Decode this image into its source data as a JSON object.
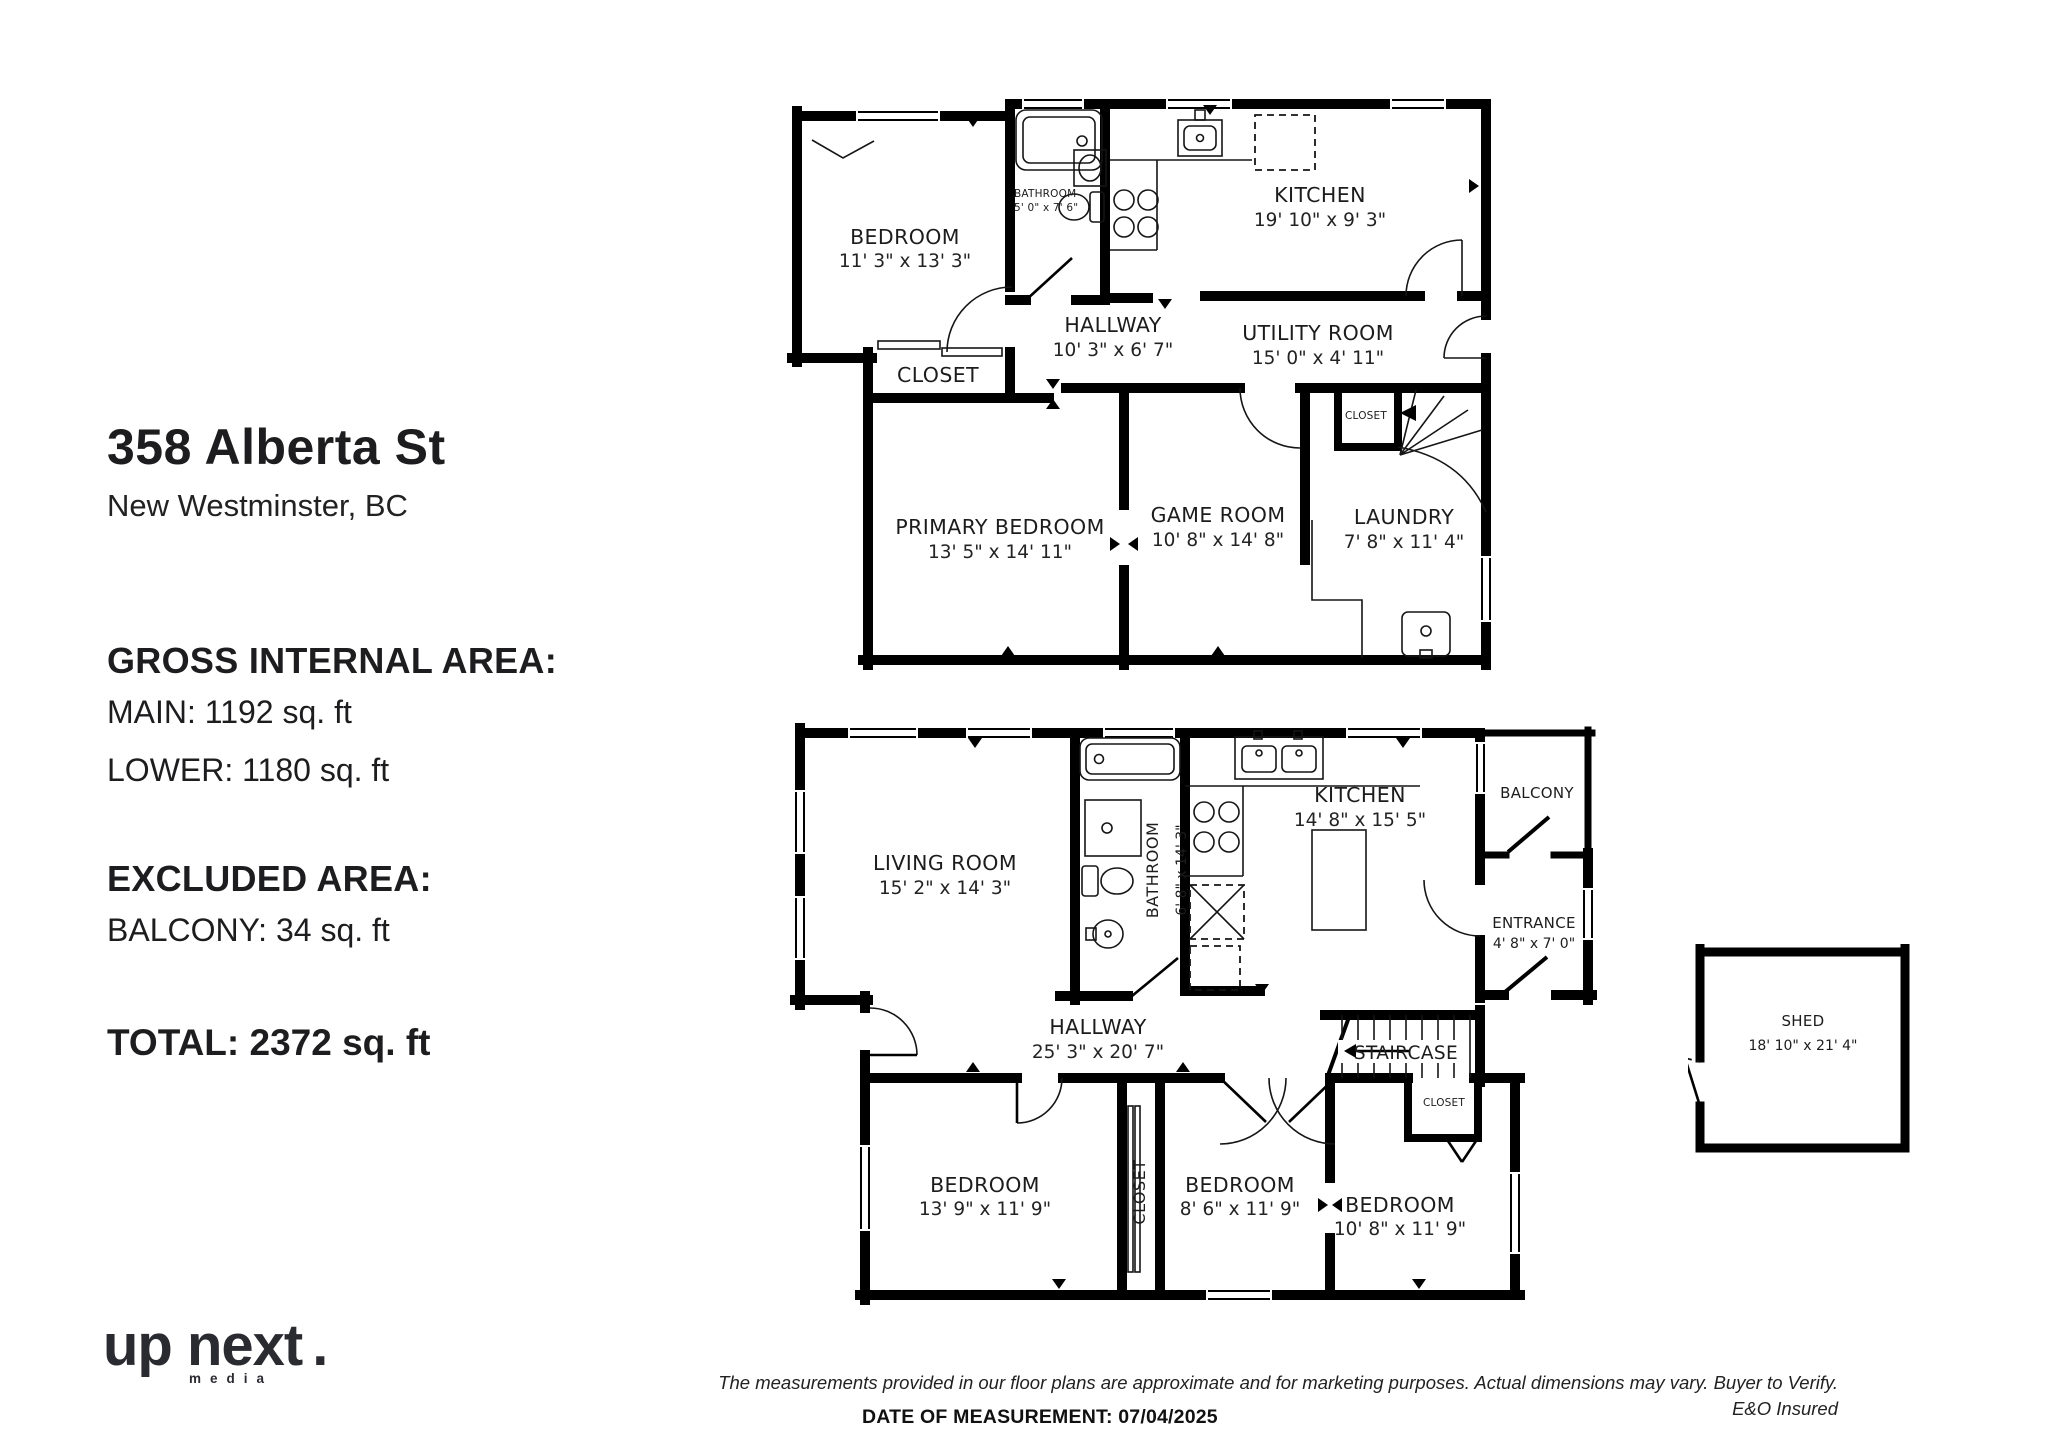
{
  "listing": {
    "address": "358 Alberta St",
    "city": "New Westminster, BC"
  },
  "areas": {
    "gross_title": "GROSS INTERNAL AREA:",
    "main": "MAIN: 1192 sq. ft",
    "lower": "LOWER: 1180 sq. ft",
    "excluded_title": "EXCLUDED AREA:",
    "balcony": "BALCONY: 34 sq. ft",
    "total": "TOTAL: 2372 sq. ft"
  },
  "main_floor": {
    "bedroom": {
      "name": "BEDROOM",
      "dims": "11' 3\" x 13' 3\""
    },
    "bathroom": {
      "name": "BATHROOM",
      "dims": "5' 0\" x 7' 6\""
    },
    "kitchen": {
      "name": "KITCHEN",
      "dims": "19' 10\" x 9' 3\""
    },
    "hallway": {
      "name": "HALLWAY",
      "dims": "10' 3\" x 6' 7\""
    },
    "utility": {
      "name": "UTILITY ROOM",
      "dims": "15' 0\" x 4' 11\""
    },
    "closet": {
      "name": "CLOSET"
    },
    "primary": {
      "name": "PRIMARY BEDROOM",
      "dims": "13' 5\" x 14' 11\""
    },
    "game": {
      "name": "GAME ROOM",
      "dims": "10' 8\" x 14' 8\""
    },
    "laundry": {
      "name": "LAUNDRY",
      "dims": "7' 8\" x 11' 4\""
    },
    "stair_closet": {
      "name": "CLOSET"
    }
  },
  "lower_floor": {
    "living": {
      "name": "LIVING ROOM",
      "dims": "15' 2\" x 14' 3\""
    },
    "bathroom": {
      "name": "BATHROOM",
      "dims": "6' 8\" x 14' 3\""
    },
    "kitchen": {
      "name": "KITCHEN",
      "dims": "14' 8\" x 15' 5\""
    },
    "balcony": {
      "name": "BALCONY"
    },
    "entrance": {
      "name": "ENTRANCE",
      "dims": "4' 8\" x 7' 0\""
    },
    "hallway": {
      "name": "HALLWAY",
      "dims": "25' 3\" x 20' 7\""
    },
    "staircase": {
      "name": "STAIRCASE"
    },
    "stair_closet": {
      "name": "CLOSET"
    },
    "bedroom_left": {
      "name": "BEDROOM",
      "dims": "13' 9\" x 11' 9\""
    },
    "closet": {
      "name": "CLOSET"
    },
    "bedroom_mid": {
      "name": "BEDROOM",
      "dims": "8' 6\" x 11' 9\""
    },
    "bedroom_right": {
      "name": "BEDROOM",
      "dims": "10' 8\" x 11' 9\""
    }
  },
  "shed": {
    "name": "SHED",
    "dims": "18' 10\" x 21' 4\""
  },
  "footer": {
    "disclaimer": "The measurements provided in our floor plans are approximate and for marketing purposes. Actual dimensions may vary. Buyer to Verify.",
    "eo": "E&O Insured",
    "date": "DATE OF MEASUREMENT: 07/04/2025"
  },
  "logo": {
    "brand": "up next",
    "dot": ".",
    "sub": "media"
  }
}
